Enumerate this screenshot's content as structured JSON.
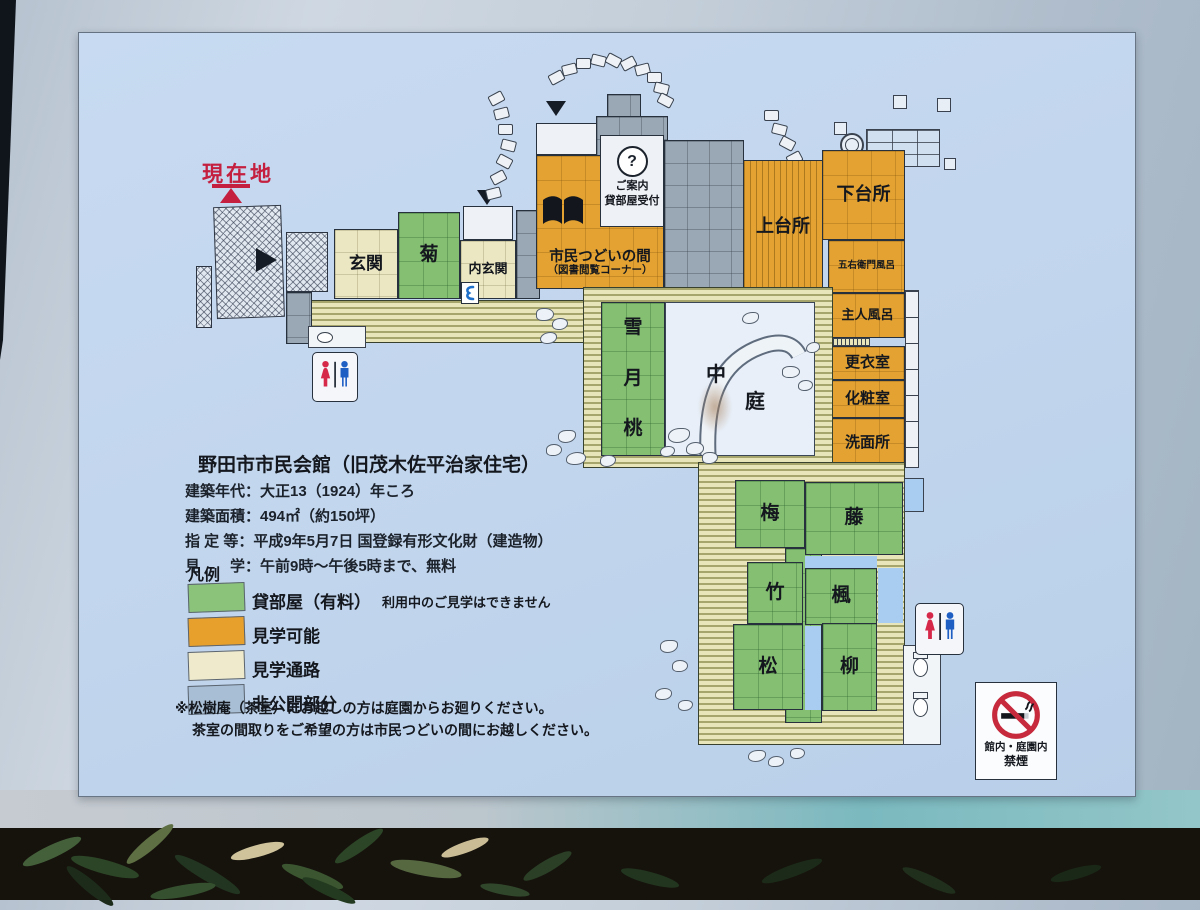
{
  "sign": {
    "current_location": "現在地",
    "title": "野田市市民会館（旧茂木佐平治家住宅）",
    "info_lines": [
      "建築年代：大正13（1924）年ころ",
      "建築面積：494㎡（約150坪）",
      "指 定 等：平成9年5月7日 国登録有形文化財（建造物）",
      "見　　学：午前9時～午後5時まで、無料"
    ],
    "legend": {
      "title": "凡例",
      "items": [
        {
          "label": "貸部屋（有料）",
          "note": "利用中のご見学はできません",
          "color": "#8bc37a"
        },
        {
          "label": "見学可能",
          "note": "",
          "color": "#e8a02d"
        },
        {
          "label": "見学通路",
          "note": "",
          "color": "#eeeacb"
        },
        {
          "label": "非公開部分",
          "note": "",
          "color": "#a8bed4"
        }
      ]
    },
    "notes": [
      "※松樹庵（茶室）にお越しの方は庭園からお廻りください。",
      "茶室の間取りをご希望の方は市民つどいの間にお越しください。"
    ],
    "reception": {
      "mark": "?",
      "line1": "ご案内",
      "line2": "貸部屋受付"
    },
    "no_smoking": {
      "line1": "館内・庭園内",
      "line2": "禁煙"
    },
    "rooms": {
      "genkan": "玄関",
      "kiku": "菊",
      "uchigenkan": "内玄関",
      "tsudoi": "市民つどいの間",
      "tsudoi_sub": "（図書閲覧コーナー）",
      "kamidaidokoro": "上台所",
      "shimodaidokoro": "下台所",
      "goemonburo": "五右衛門風呂",
      "shujinburo": "主人風呂",
      "koishitsu": "更衣室",
      "keshoshitsu": "化粧室",
      "senmenjo": "洗面所",
      "yuki": "雪",
      "tsuki": "月",
      "momo": "桃",
      "naka": "中",
      "niwa": "庭",
      "ume": "梅",
      "fuji": "藤",
      "take": "竹",
      "kaede": "楓",
      "matsu": "松",
      "yanagi": "柳"
    },
    "colors": {
      "panel_bg": "#c3d7ee",
      "rental_green": "#85bf72",
      "viewable_orange": "#e3a231",
      "corridor_cream": "#ebe7c3",
      "private_gray": "#9aa7b4",
      "accent_red": "#c41f3e"
    }
  }
}
